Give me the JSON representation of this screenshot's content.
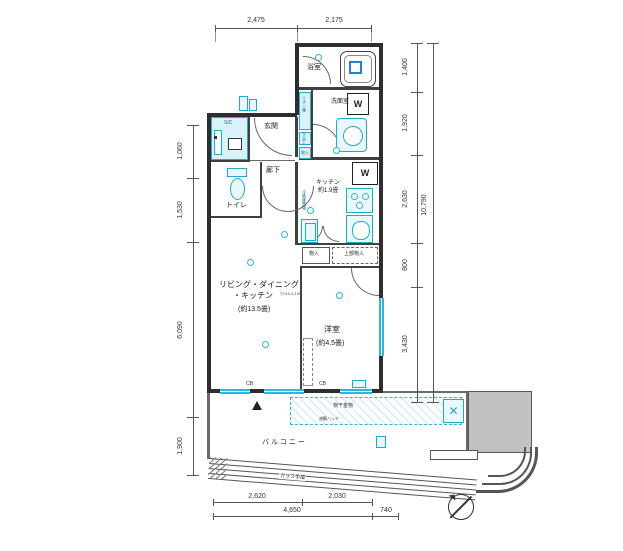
{
  "rooms": {
    "bathroom": "浴室",
    "washroom": "洗面室",
    "linen": "リネン庫",
    "shoe": "下足入",
    "storage": "物入",
    "sic": "SIC",
    "entrance": "玄関",
    "hallway": "廊下",
    "toilet": "トイレ",
    "kitchen": "キッチン",
    "kitchen_size": "約1.9畳",
    "fridge": "冷蔵庫置場",
    "ldk1": "リビング・ダイニング",
    "ldk2": "・キッチン",
    "ldk_size": "(約13.5畳)",
    "bedroom": "洋室",
    "bedroom_size": "(約4.5畳)",
    "closet_upper": "上部物入",
    "balcony": "バルコニー"
  },
  "fixtures": {
    "washer": "W"
  },
  "notes": {
    "cb": "CB",
    "ch": "▽CH=2,100",
    "laundry": "物干金物",
    "hatch": "避難ハッチ",
    "railing": "ガラス手摺"
  },
  "dims": {
    "top": [
      "2,475",
      "2,175"
    ],
    "left": [
      "1,060",
      "1,530",
      "6,090",
      "1,900"
    ],
    "right": [
      "1,400",
      "1,920",
      "2,630",
      "800",
      "3,430"
    ],
    "right_total": "10,790",
    "bottom1": [
      "2,620",
      "2,030"
    ],
    "bottom2": [
      "4,650",
      "740"
    ]
  },
  "colors": {
    "fixture": "#2cb7d8",
    "wall": "#2e2e2e",
    "gray": "#c2c2c2"
  }
}
